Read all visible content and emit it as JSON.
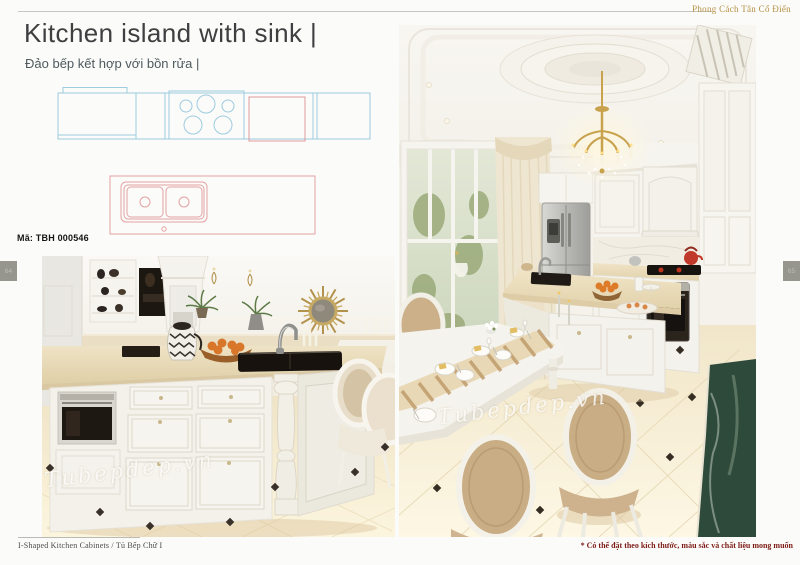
{
  "brand": "Phong Cách Tân Cổ Điển",
  "title": "Kitchen island with sink |",
  "subtitle": "Đảo bếp kết hợp với bồn rửa |",
  "product_code": "Mã: TBH 000546",
  "page_numbers": {
    "left": "64",
    "right": "65"
  },
  "footer": {
    "series": "I-Shaped Kitchen Cabinets  /  Tủ Bếp Chữ I",
    "note": "* Có thể đặt theo kích thước, màu sắc và chất liệu mong muốn"
  },
  "watermark": "Tubepdep.vn",
  "colors": {
    "brand_gold": "#b49043",
    "blueprint_blue": "#9ecbdf",
    "blueprint_red": "#e09b9b",
    "note_red": "#7d1b16",
    "tab_gray": "#97968e"
  }
}
